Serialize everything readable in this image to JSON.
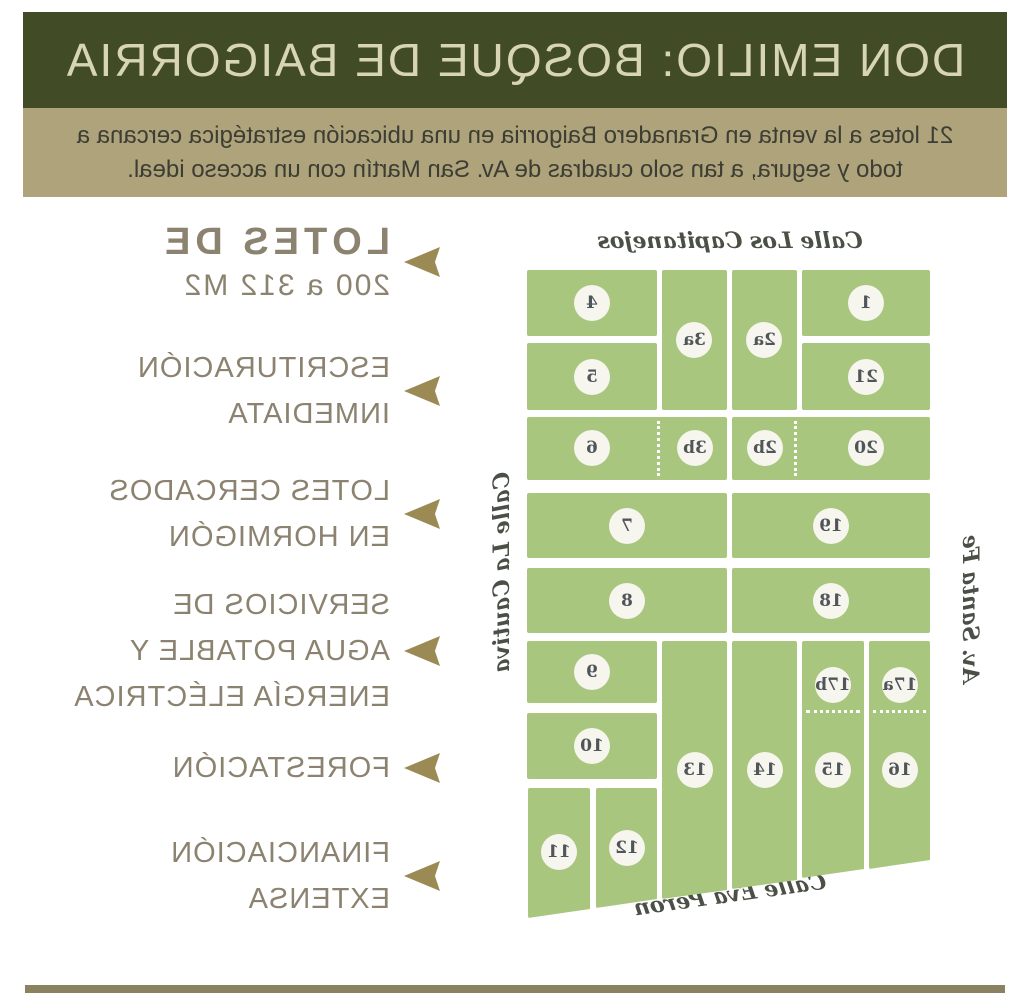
{
  "header": {
    "title": "DON EMILIO: BOSQUE DE BAIGORRIA"
  },
  "subtitle": {
    "line1": "21 lotes a la venta en Granadero Baigorria en una ubicación estratégica cercana a",
    "line2": "todo y segura, a tan solo cuadras de Av. San Martín con un acceso ideal."
  },
  "features": [
    {
      "lines": [
        "LOTES DE",
        "200 a 312 M2"
      ]
    },
    {
      "lines": [
        "ESCRITURACIÓN",
        "INMEDIATA"
      ]
    },
    {
      "lines": [
        "LOTES CERCADOS",
        "EN HORMIGÓN"
      ]
    },
    {
      "lines": [
        "SERVICIOS DE",
        "AGUA POTABLE Y",
        "ENERGÍA ELÉCTRICA"
      ]
    },
    {
      "lines": [
        "FORESTACIÓN"
      ]
    },
    {
      "lines": [
        "FINANCIACIÓN",
        "EXTENSA"
      ]
    }
  ],
  "map": {
    "streets": {
      "top": "Calle Los Capitanejos",
      "left": "Av. Santa Fe",
      "right": "Calle La Cautiva",
      "bottom": "Calle Eva Perón"
    },
    "lots": {
      "1": "1",
      "2a": "2a",
      "3a": "3a",
      "4": "4",
      "5": "5",
      "20": "20",
      "2b": "2b",
      "3b": "3b",
      "6": "6",
      "19": "19",
      "7": "7",
      "18": "18",
      "8": "8",
      "9": "9",
      "10": "10",
      "11": "11",
      "12": "12",
      "13": "13",
      "14": "14",
      "15": "15",
      "16": "16",
      "17a": "17a",
      "17b": "17b",
      "21": "21"
    }
  },
  "colors": {
    "header_bg": "#414c27",
    "header_text": "#d8d5b3",
    "subtitle_bg": "#afa37c",
    "lot_green": "#a8c67d",
    "arrow_gold": "#9c8a55",
    "feature_text": "#8c8270",
    "footer_rule": "#8a8260"
  },
  "note": {
    "orientation": "image is horizontally mirrored"
  }
}
